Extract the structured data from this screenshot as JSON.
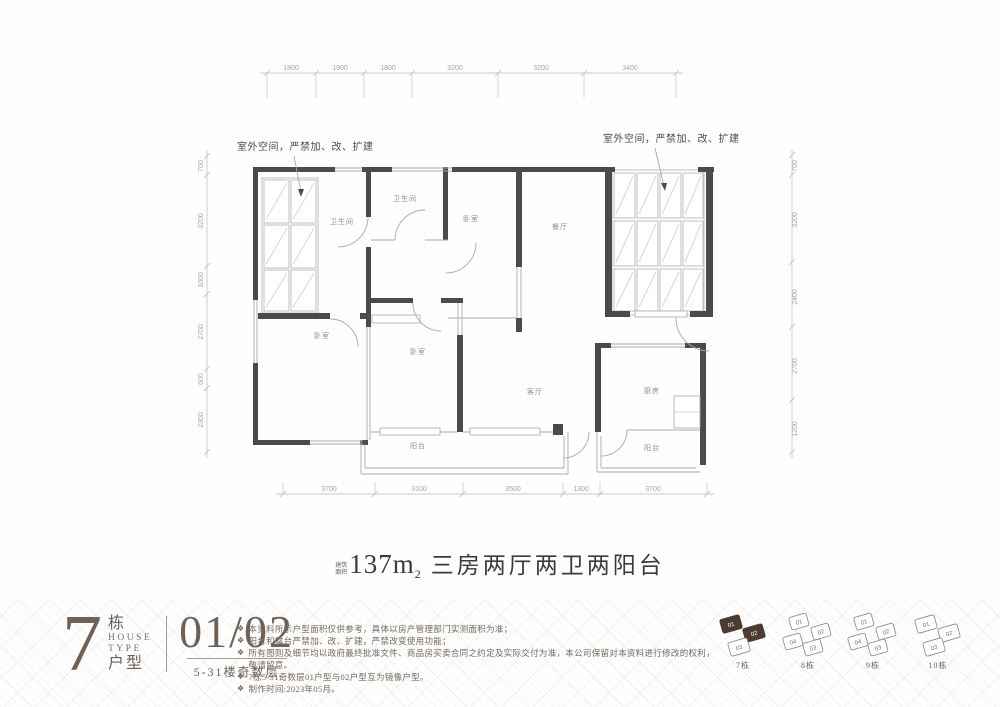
{
  "colors": {
    "wall_dark": "#4b4b4d",
    "thin_line": "#a9a9a9",
    "title_text": "#3b3b3d",
    "brand_brown": "#6e6157",
    "keyplan_highlight": "#4b3b31"
  },
  "plan": {
    "annotations": [
      "室外空间，严禁加、改、扩建",
      "室外空间，严禁加、改、扩建"
    ],
    "rooms": [
      "卫生间",
      "卫生间",
      "卧室",
      "餐厅",
      "卧室",
      "卧室",
      "客厅",
      "厨房",
      "阳台",
      "阳台"
    ],
    "dims": {
      "top": [
        "1800",
        "1900",
        "1800",
        "3200",
        "3200",
        "3400"
      ],
      "bottom": [
        "3700",
        "3100",
        "3500",
        "1300",
        "3700"
      ],
      "left": [
        "700",
        "3200",
        "1000",
        "2700",
        "600",
        "2300"
      ],
      "right": [
        "700",
        "3200",
        "2400",
        "2700",
        "1200"
      ]
    }
  },
  "title": {
    "area_label_1": "建筑",
    "area_label_2": "面积",
    "area_value": "137m",
    "area_sup": "2",
    "desc": "三房两厅两卫两阳台"
  },
  "footer": {
    "block_number": "7",
    "block_word": "栋",
    "house_word": "HOUSE",
    "type_word": "TYPE",
    "huxing_word": "户型",
    "units": "01/02",
    "floors": "5-31楼奇数层",
    "bullet": "❖",
    "notes": [
      "本资料所示户型面积仅供参考，具体以房产管理部门实测面积为准；",
      "阳台和露台严禁加、改、扩建，严禁改变使用功能；",
      "所有图则及细节均以政府最终批准文件、商品房买卖合同之约定及实际交付为准，本公司保留对本资料进行修改的权利，敬请留意。",
      "7栋5-31奇数层01户型与02户型互为镜像户型。",
      "制作时间:2023年05月。"
    ],
    "keyplans": [
      {
        "name": "7栋",
        "units": [
          "01",
          "02",
          "03"
        ]
      },
      {
        "name": "8栋",
        "units": [
          "01",
          "02",
          "03",
          "04"
        ]
      },
      {
        "name": "9栋",
        "units": [
          "01",
          "02",
          "03",
          "04"
        ]
      },
      {
        "name": "10栋",
        "units": [
          "01",
          "02",
          "03"
        ]
      }
    ]
  }
}
